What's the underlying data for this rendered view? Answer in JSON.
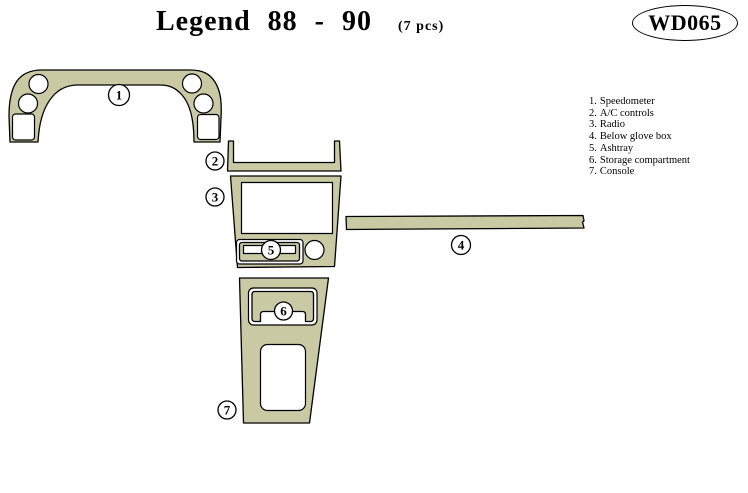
{
  "header": {
    "title": "Legend  88 - 90",
    "count": "(7  pcs)",
    "badge": "WD065"
  },
  "legend": {
    "items": [
      {
        "num": "1.",
        "name": "Speedometer"
      },
      {
        "num": "2.",
        "name": "A/C controls"
      },
      {
        "num": "3.",
        "name": "Radio"
      },
      {
        "num": "4.",
        "name": "Below glove box"
      },
      {
        "num": "5.",
        "name": "Ashtray"
      },
      {
        "num": "6.",
        "name": "Storage compartment"
      },
      {
        "num": "7.",
        "name": "Console"
      }
    ]
  },
  "callouts": [
    "1",
    "2",
    "3",
    "4",
    "5",
    "6",
    "7"
  ],
  "colors": {
    "panel_fill": "#c9c9a4",
    "outline": "#000000",
    "background": "#ffffff"
  }
}
